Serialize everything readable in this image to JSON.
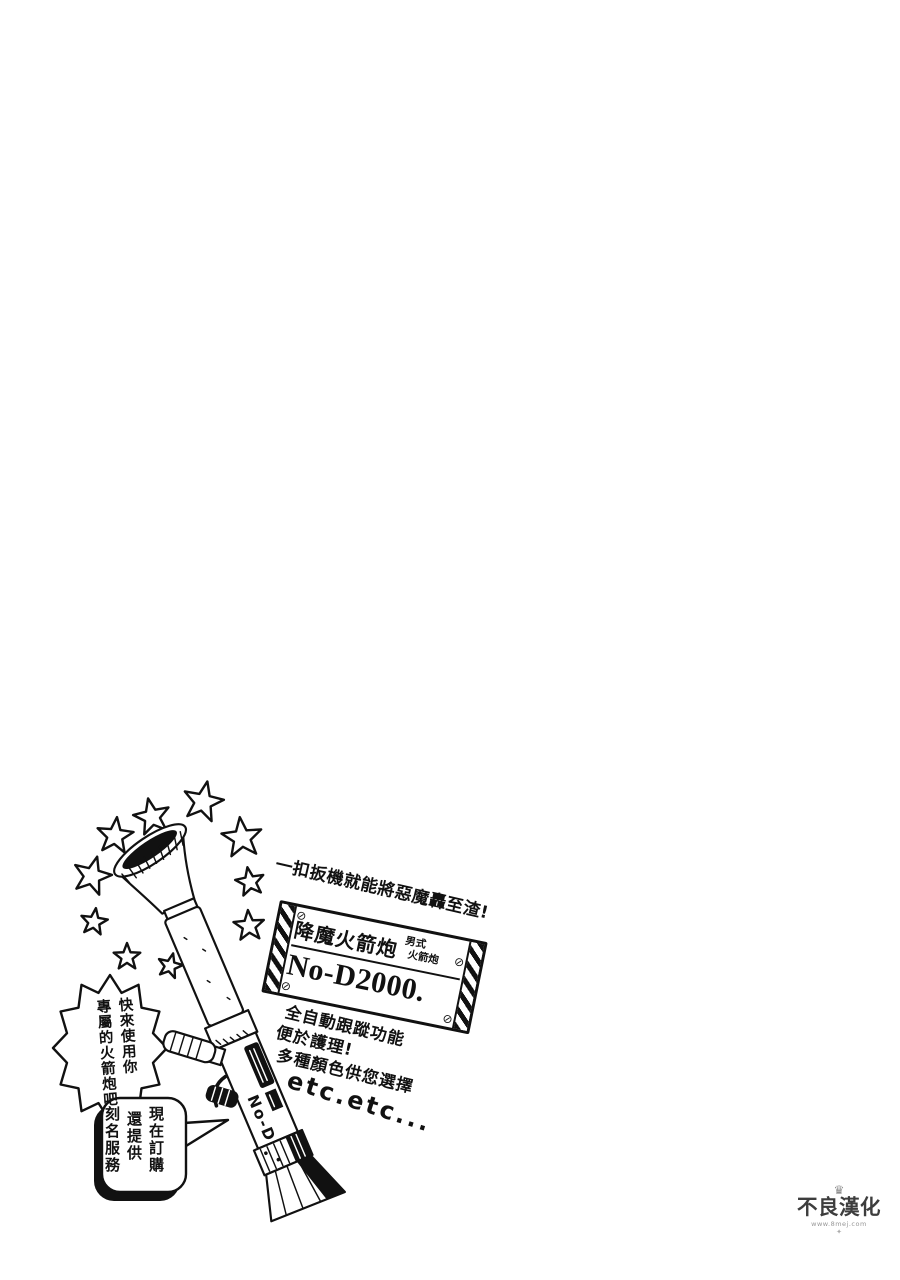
{
  "page": {
    "bg": "#ffffff",
    "ink": "#111111"
  },
  "illustration": {
    "slogan": "一扣扳機就能將惡魔轟至渣!",
    "sign": {
      "title": "降魔火箭炮",
      "type_label_top": "男式",
      "type_label_bottom": "火箭炮",
      "model": "No-D2000.",
      "screw_glyph": "⊘"
    },
    "promo": {
      "lines": [
        "全自動跟蹤功能",
        "便於護理!",
        "多種顏色供您選擇"
      ],
      "etc": "etc.etc..."
    },
    "spiky_bubble": {
      "columns": [
        "快來使用你",
        "專屬的火箭炮吧"
      ]
    },
    "order_bubble": {
      "columns": [
        "現在訂購",
        "還提供",
        "刻名服務"
      ]
    },
    "barrel_label": "No-D"
  },
  "watermark": {
    "crown_glyph": "♛",
    "name": "不良漢化",
    "subtext": "www.8mej.com",
    "ornament_glyph": "✦"
  }
}
